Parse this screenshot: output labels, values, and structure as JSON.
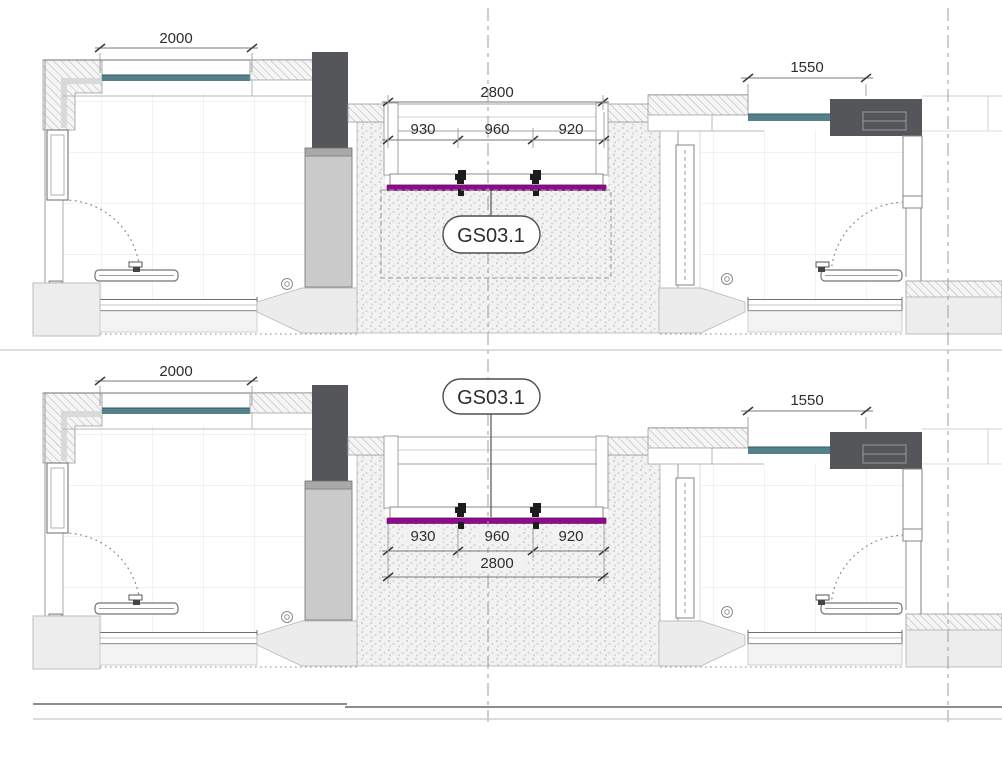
{
  "annotations": {
    "top_view": {
      "window_dim_left": "2000",
      "window_dim_right": "1550",
      "partition_total": "2800",
      "partition_segments": [
        "930",
        "960",
        "920"
      ],
      "callout": "GS03.1"
    },
    "bottom_view": {
      "window_dim_left": "2000",
      "window_dim_right": "1550",
      "partition_total": "2800",
      "partition_segments": [
        "930",
        "960",
        "920"
      ],
      "callout": "GS03.1"
    }
  },
  "colors": {
    "partition_line": "#8d0b8d",
    "glazing": "#54808a",
    "dark_fitment": "#55565a",
    "column": "#cacaca"
  }
}
